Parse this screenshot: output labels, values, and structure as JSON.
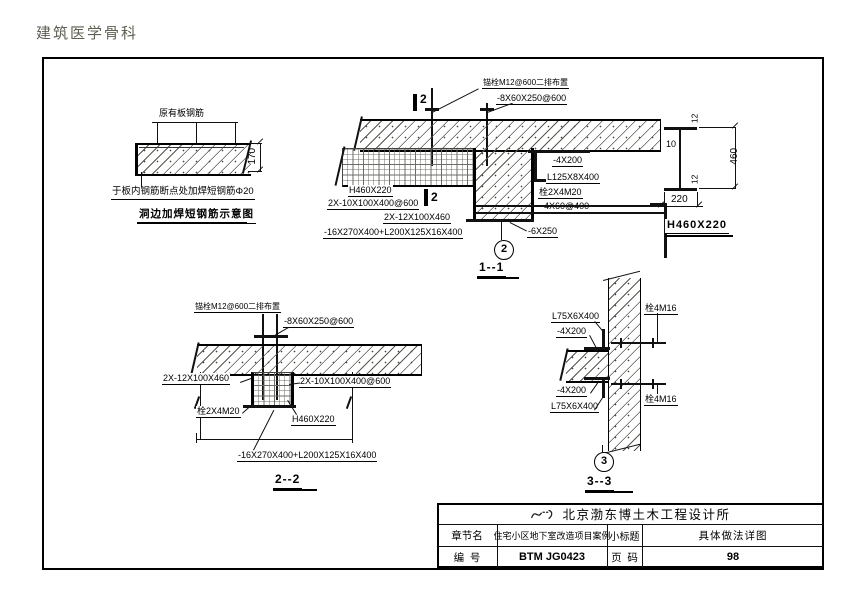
{
  "watermark": "建筑医学骨科",
  "weld_detail": {
    "rebar_label": "原有板钢筋",
    "dim": "170",
    "note": "于板内钢筋断点处加焊短钢筋Φ20",
    "title": "洞边加焊短钢筋示意图"
  },
  "section_1_1": {
    "anchor_note": "锚栓M12@600二排布置",
    "batten_plate": "-8X60X250@600",
    "cut_number": "2",
    "beam": "H460X220",
    "stiffener_pair": "2X-10X100X400@600",
    "end_plate_pair": "2X-12X100X460",
    "base_assembly": "-16X270X400+L200X125X16X400",
    "plate_top": "-4X200",
    "angle": "L125X8X400",
    "bolts": "栓2X4M20",
    "batten_small": "-4X60@400",
    "sole_plate": "-6X250",
    "bubble": "2",
    "title": "1--1"
  },
  "h_section": {
    "flange_top": "12",
    "web": "10",
    "depth": "460",
    "flange_bottom": "12",
    "width": "220",
    "title": "H460X220"
  },
  "section_2_2": {
    "anchor_note": "锚栓M12@600二排布置",
    "batten_plate": "-8X60X250@600",
    "end_plate_pair": "2X-12X100X460",
    "stiffener_pair": "2X-10X100X400@600",
    "bolts": "栓2X4M20",
    "beam": "H460X220",
    "base_assembly": "-16X270X400+L200X125X16X400",
    "title": "2--2"
  },
  "section_3_3": {
    "angle_top": "L75X6X400",
    "plate_top": "-4X200",
    "plate_bottom": "-4X200",
    "angle_bottom": "L75X6X400",
    "bolts_top": "栓4M16",
    "bolts_bottom": "栓4M16",
    "bubble": "3",
    "title": "3--3"
  },
  "title_block": {
    "company": "北京渤东博土木工程设计所",
    "chapter_label": "章节名",
    "chapter_value": "住宅小区地下室改造项目案例",
    "subtitle_label": "小标题",
    "subtitle_value": "具体做法详图",
    "number_label": "编  号",
    "number_value": "BTM JG0423",
    "page_label": "页  码",
    "page_value": "98"
  }
}
